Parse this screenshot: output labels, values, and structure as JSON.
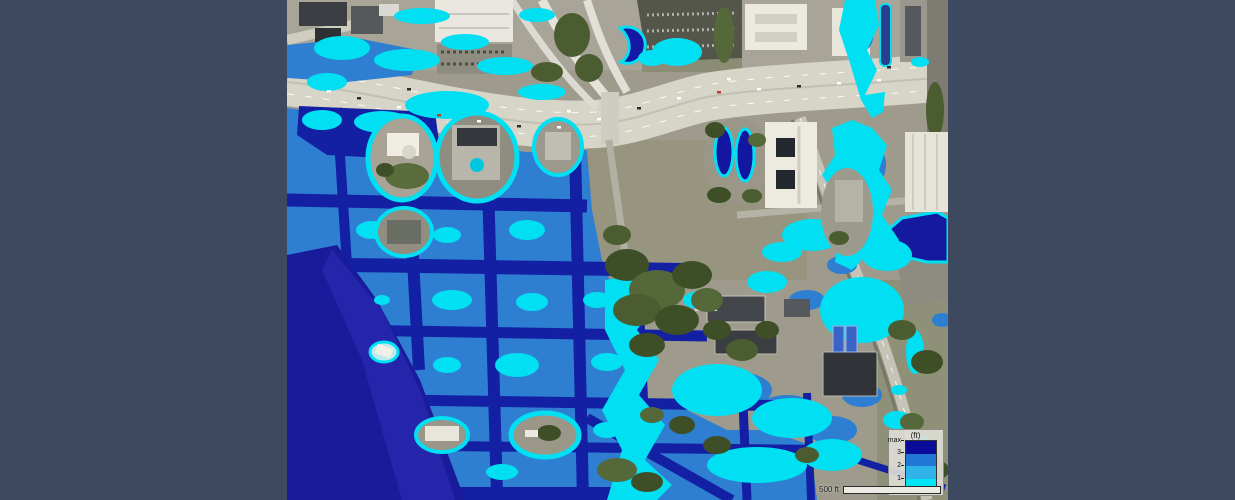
{
  "window": {
    "background": "#3d495e"
  },
  "map": {
    "left": 287,
    "width": 661,
    "height": 500,
    "description": "satellite imagery with coastal flood depth overlay",
    "colors": {
      "land": "#9e9b8d",
      "highway": "#d7d4c8",
      "bay_deep": "#191c9a",
      "bay_nearshore": "#2727ae",
      "flood_deep": "#1420a4",
      "flood_medium": "#2e7fd2",
      "flood_shallow": "#3aa9e4",
      "flood_minimal": "#00e0f2",
      "vegetation": "#4a5c30"
    }
  },
  "legend": {
    "unit_label": "(ft)",
    "ticks": [
      "max",
      "3",
      "2",
      "1",
      "0"
    ],
    "bands": [
      {
        "range": "3-max",
        "color": "#0b0b9a"
      },
      {
        "range": "2-3",
        "color": "#2277d4"
      },
      {
        "range": "1-2",
        "color": "#2fb3e8"
      },
      {
        "range": "0-1",
        "color": "#00e4f4"
      }
    ]
  },
  "scalebar": {
    "label": "500 ft"
  }
}
